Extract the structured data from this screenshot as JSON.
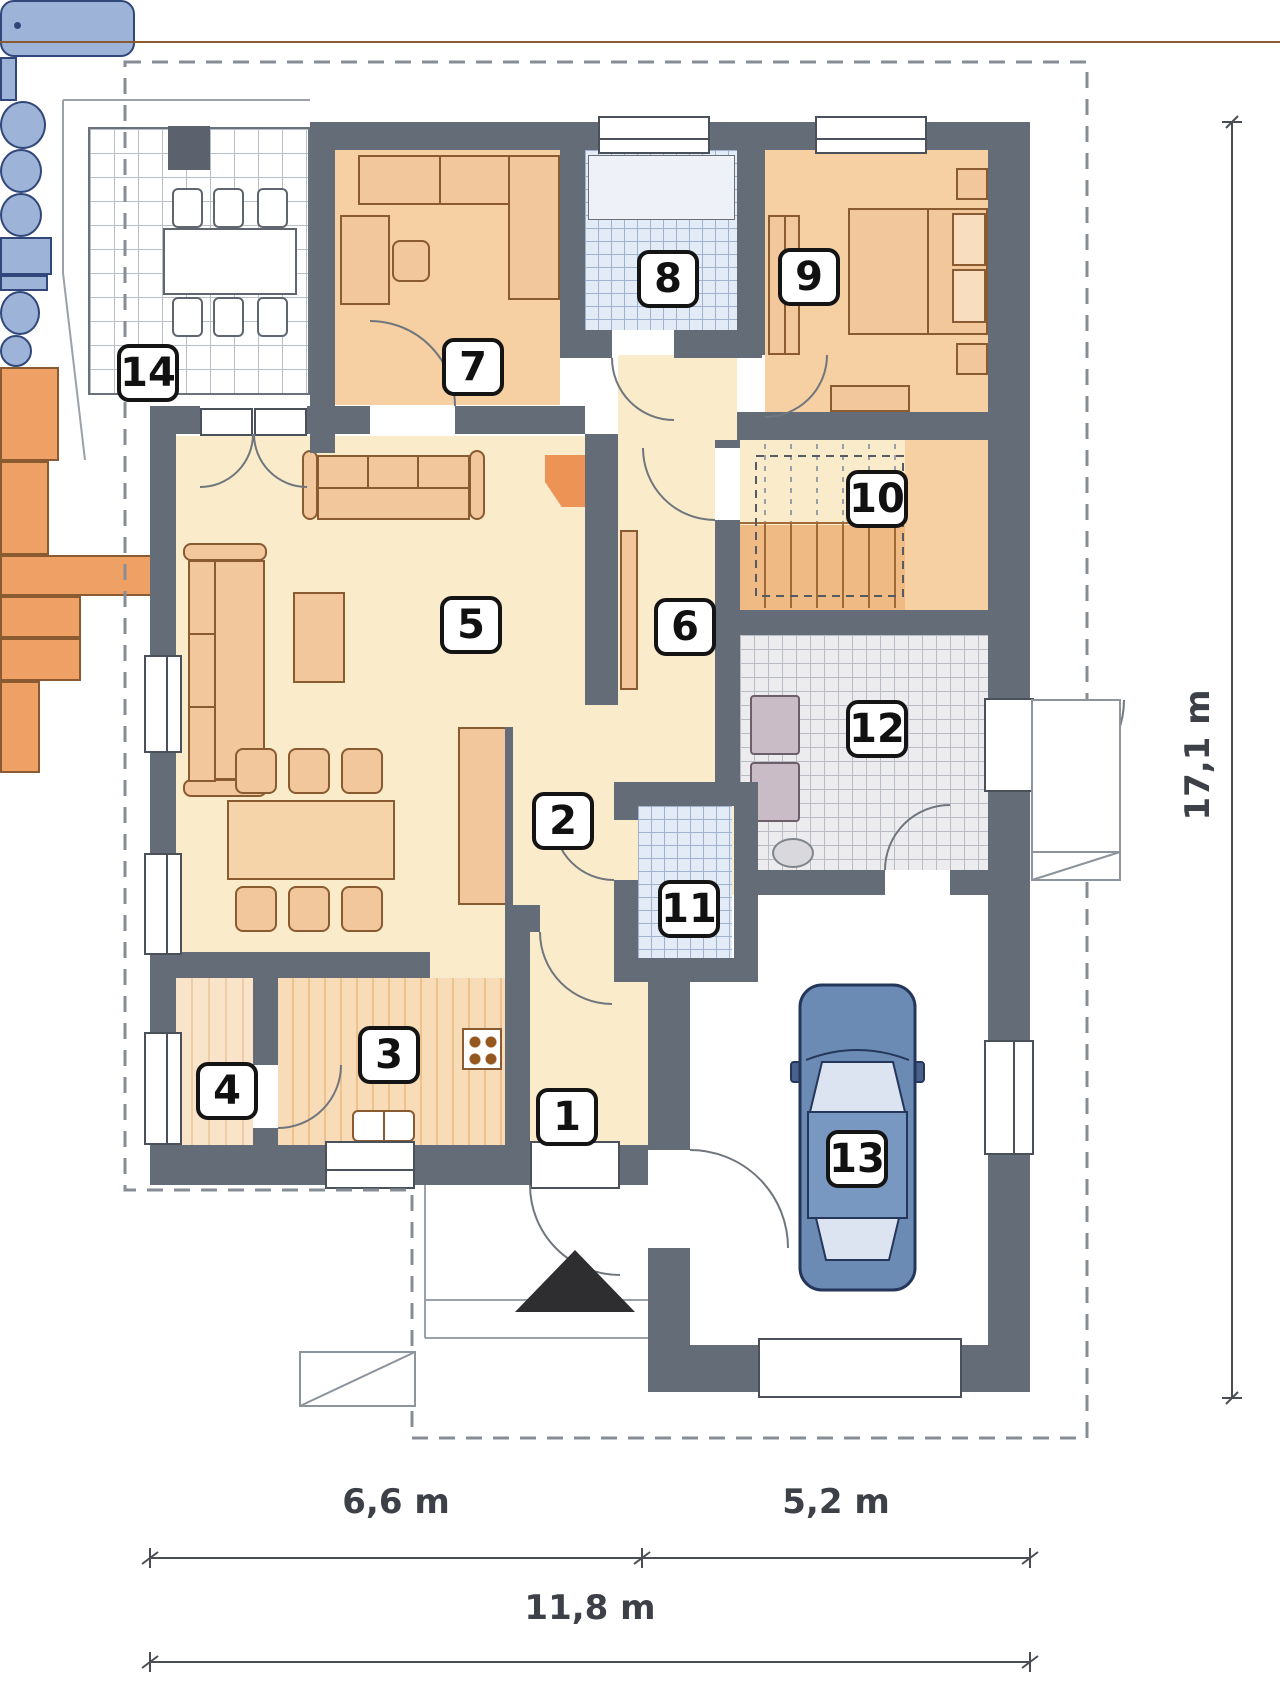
{
  "plan_type": "single-storey house floor plan with garage",
  "rooms": [
    {
      "number": "1"
    },
    {
      "number": "2"
    },
    {
      "number": "3"
    },
    {
      "number": "4"
    },
    {
      "number": "5"
    },
    {
      "number": "6"
    },
    {
      "number": "7"
    },
    {
      "number": "8"
    },
    {
      "number": "9"
    },
    {
      "number": "10"
    },
    {
      "number": "11"
    },
    {
      "number": "12"
    },
    {
      "number": "13"
    },
    {
      "number": "14"
    }
  ],
  "dimensions": {
    "bottom_left": "6,6 m",
    "bottom_right": "5,2 m",
    "bottom_total": "11,8 m",
    "right_total": "17,1 m"
  },
  "colors": {
    "wall": "#646c77",
    "floor_cream": "#faecca",
    "floor_peach": "#f6cfa2",
    "furniture_peach": "#f2c79b",
    "accent_orange": "#efa064",
    "stairs_orange": "#f0ba85",
    "fixture_blue": "#9db4d8",
    "bath_tile": "#e3ebf6",
    "utility_tile": "#ececef",
    "car_blue": "#6b8bb5",
    "dashed_boundary": "#878d95"
  },
  "icons": {
    "entry_arrow": "black triangle marking main entrance",
    "car": "car top view parked in garage",
    "fireplace": "corner fireplace in living room",
    "grill": "grill on terrace",
    "stairs": "staircase with dashed headroom outline"
  }
}
